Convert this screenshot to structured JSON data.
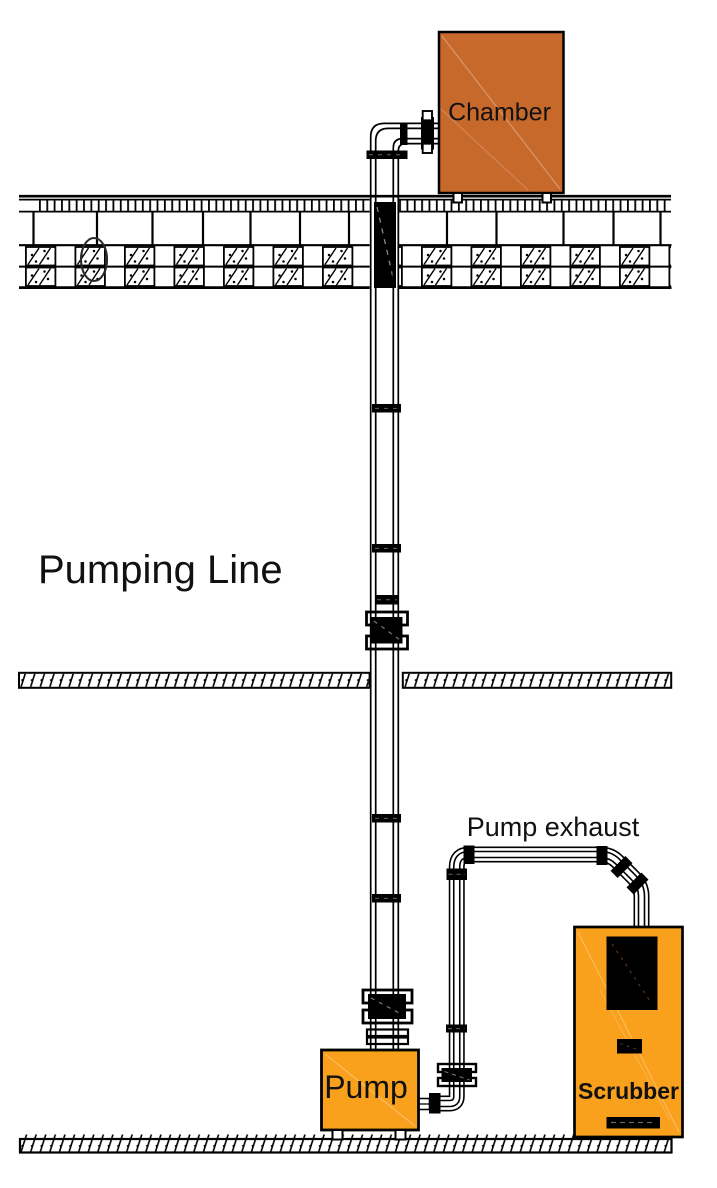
{
  "diagram": {
    "type": "vacuum-pumping-system-schematic",
    "labels": {
      "chamber": "Chamber",
      "pumping_line": "Pumping Line",
      "pump_exhaust": "Pump exhaust",
      "pump": "Pump",
      "scrubber": "Scrubber"
    },
    "colors": {
      "chamber_fill": "#C8692C",
      "equipment_fill": "#F9A01D",
      "outline": "#000000",
      "detail_dash": "#666666"
    }
  }
}
